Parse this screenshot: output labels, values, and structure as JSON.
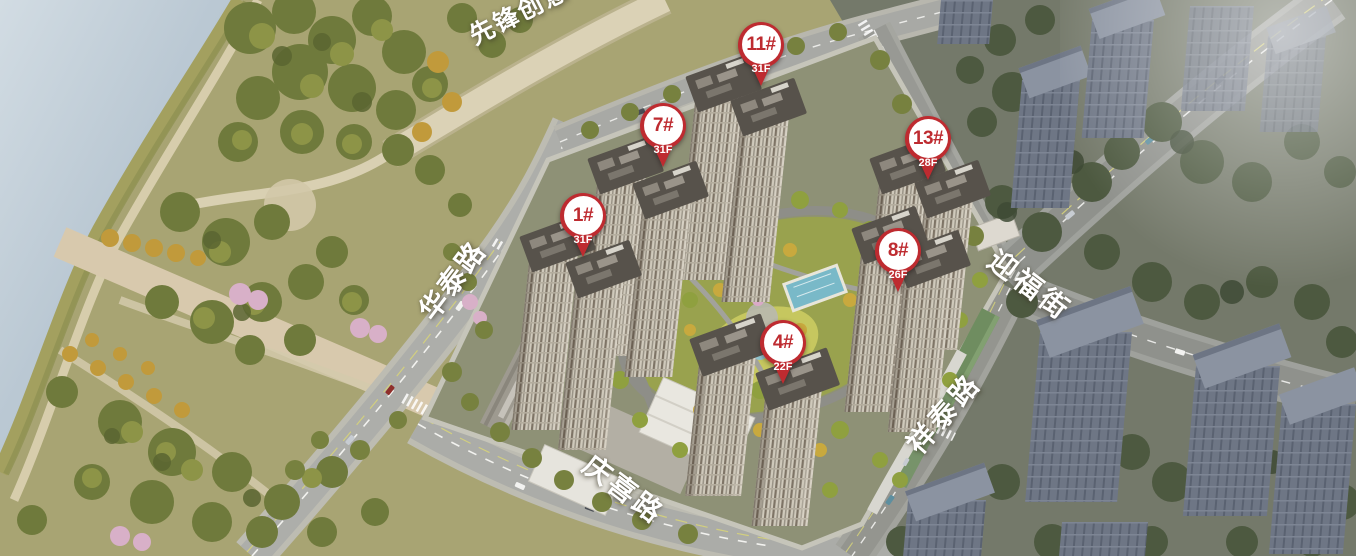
{
  "markers": [
    {
      "id": "1#",
      "floors": "31F"
    },
    {
      "id": "7#",
      "floors": "31F"
    },
    {
      "id": "11#",
      "floors": "31F"
    },
    {
      "id": "13#",
      "floors": "28F"
    },
    {
      "id": "8#",
      "floors": "26F"
    },
    {
      "id": "4#",
      "floors": "22F"
    }
  ],
  "road_labels": [
    {
      "name": "先锋创意"
    },
    {
      "name": "华泰路"
    },
    {
      "name": "迎福街"
    },
    {
      "name": "祥泰路"
    },
    {
      "name": "庆喜路"
    }
  ],
  "colors": {
    "pin_red": "#be2b30",
    "road_label": "#ffffff"
  }
}
